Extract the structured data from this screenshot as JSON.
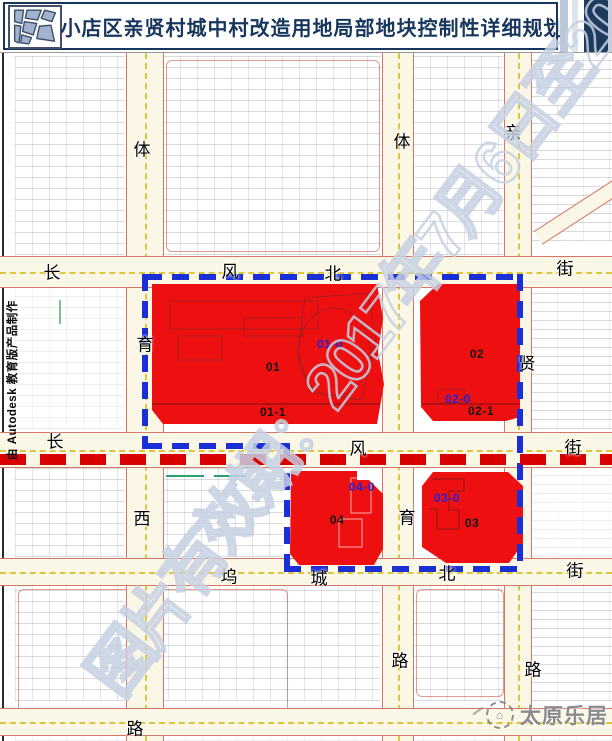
{
  "header": {
    "title": "小店区亲贤村城中村改造用地局部地块控制性详细规划",
    "logo_name": "parcel-map-logo"
  },
  "map": {
    "street_labels": [
      {
        "text": "体",
        "x": 142,
        "y": 148
      },
      {
        "text": "育",
        "x": 145,
        "y": 343
      },
      {
        "text": "西",
        "x": 142,
        "y": 517
      },
      {
        "text": "路",
        "x": 135,
        "y": 727
      },
      {
        "text": "体",
        "x": 402,
        "y": 140
      },
      {
        "text": "育",
        "x": 407,
        "y": 516
      },
      {
        "text": "路",
        "x": 400,
        "y": 659
      },
      {
        "text": "亲",
        "x": 513,
        "y": 131
      },
      {
        "text": "贤",
        "x": 527,
        "y": 362
      },
      {
        "text": "路",
        "x": 533,
        "y": 668
      },
      {
        "text": "长",
        "x": 52,
        "y": 271
      },
      {
        "text": "风",
        "x": 230,
        "y": 270
      },
      {
        "text": "北",
        "x": 333,
        "y": 272
      },
      {
        "text": "街",
        "x": 565,
        "y": 267
      },
      {
        "text": "长",
        "x": 55,
        "y": 440
      },
      {
        "text": "风",
        "x": 358,
        "y": 447
      },
      {
        "text": "街",
        "x": 573,
        "y": 446
      },
      {
        "text": "坞",
        "x": 229,
        "y": 575
      },
      {
        "text": "城",
        "x": 319,
        "y": 577
      },
      {
        "text": "北",
        "x": 447,
        "y": 572
      },
      {
        "text": "街",
        "x": 575,
        "y": 569
      }
    ],
    "parcel_labels": [
      {
        "text": "01-0",
        "x": 330,
        "y": 344,
        "color": "blue"
      },
      {
        "text": "01",
        "x": 273,
        "y": 367,
        "color": "dark"
      },
      {
        "text": "01-1",
        "x": 273,
        "y": 412,
        "color": "dark"
      },
      {
        "text": "02",
        "x": 477,
        "y": 354,
        "color": "dark"
      },
      {
        "text": "02-0",
        "x": 458,
        "y": 399,
        "color": "blue"
      },
      {
        "text": "02-1",
        "x": 481,
        "y": 411,
        "color": "dark"
      },
      {
        "text": "04-0",
        "x": 362,
        "y": 487,
        "color": "blue"
      },
      {
        "text": "04",
        "x": 337,
        "y": 520,
        "color": "dark"
      },
      {
        "text": "03-0",
        "x": 447,
        "y": 498,
        "color": "blue"
      },
      {
        "text": "03",
        "x": 472,
        "y": 523,
        "color": "dark"
      }
    ],
    "watermark_diagonal": "图片有效期：2017年7月6日至2017",
    "credit_vertical": "由 Autodesk 教育版产品制作",
    "brand_watermark": "太原乐居",
    "brand_logo_name": "dashed-circle-house-logo"
  },
  "colors": {
    "header_navy": "#17365d",
    "parcel_red": "#ee1010",
    "boundary_blue": "#1b2fd6",
    "planline_red": "#d80000",
    "parcel_label_blue": "#2a21d0"
  }
}
